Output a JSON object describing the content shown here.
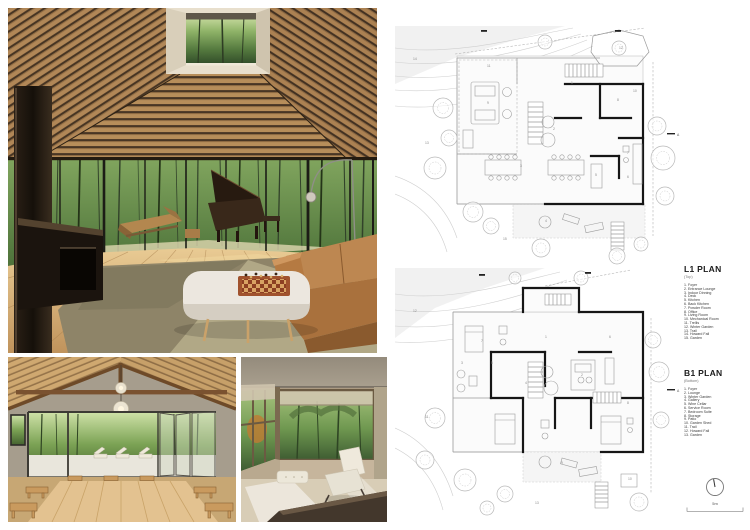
{
  "board": {
    "type": "architecture-presentation-sheet",
    "background": "#ffffff"
  },
  "palette": {
    "ceiling_wood": "#b78e5a",
    "ceiling_gap": "#483624",
    "forest_green": "#55793f",
    "floor_oak": "#d9b379",
    "sofa_leather": "#b3793f",
    "rug_olive": "#8e8468",
    "marble_table": "#ece7df",
    "fireplace_bronze": "#231a12",
    "plan_wall": "#161616",
    "plan_line": "#9a9a9a"
  },
  "renders": {
    "main": {
      "name": "living-room-render"
    },
    "pavilion": {
      "name": "dining-pavilion-render"
    },
    "nook": {
      "name": "window-nook-render"
    }
  },
  "plans": {
    "scale_label": "5m",
    "l1": {
      "title": "L1 PLAN",
      "subtitle": "(Top)",
      "section_letter": "A",
      "legend": [
        "Foyer",
        "Entrance Lounge",
        "Indoor Dinning",
        "Deck",
        "Kitchen",
        "Back Kitchen",
        "Powder Room",
        "Office",
        "Living Room",
        "Mechanical Room",
        "Trellis",
        "Winter Garden",
        "Trail",
        "Howard Fall",
        "Garden"
      ],
      "room_numbers": [
        {
          "n": "1",
          "x": 176,
          "y": 58
        },
        {
          "n": "2",
          "x": 158,
          "y": 104
        },
        {
          "n": "3",
          "x": 125,
          "y": 141
        },
        {
          "n": "4",
          "x": 150,
          "y": 196
        },
        {
          "n": "5",
          "x": 200,
          "y": 150
        },
        {
          "n": "6",
          "x": 232,
          "y": 152
        },
        {
          "n": "7",
          "x": 232,
          "y": 128
        },
        {
          "n": "8",
          "x": 222,
          "y": 75
        },
        {
          "n": "9",
          "x": 92,
          "y": 78
        },
        {
          "n": "10",
          "x": 238,
          "y": 66
        },
        {
          "n": "11",
          "x": 92,
          "y": 41
        },
        {
          "n": "12",
          "x": 224,
          "y": 23
        },
        {
          "n": "13",
          "x": 30,
          "y": 118
        },
        {
          "n": "14",
          "x": 18,
          "y": 34
        },
        {
          "n": "15",
          "x": 108,
          "y": 214
        }
      ]
    },
    "b1": {
      "title": "B1 PLAN",
      "subtitle": "(Bottom)",
      "section_letter": "A",
      "legend": [
        "Foyer",
        "Lounge",
        "Winter Garden",
        "Gallery",
        "Wine Cellar",
        "Service Room",
        "Bedroom Suite",
        "Storage",
        "Patio",
        "Garden Shed",
        "Trail",
        "Howard Fall",
        "Garden"
      ],
      "room_numbers": [
        {
          "n": "1",
          "x": 150,
          "y": 70
        },
        {
          "n": "2",
          "x": 186,
          "y": 108
        },
        {
          "n": "3",
          "x": 66,
          "y": 96
        },
        {
          "n": "4",
          "x": 130,
          "y": 116
        },
        {
          "n": "5",
          "x": 96,
          "y": 96
        },
        {
          "n": "6",
          "x": 214,
          "y": 70
        },
        {
          "n": "7",
          "x": 86,
          "y": 74
        },
        {
          "n": "8",
          "x": 232,
          "y": 136
        },
        {
          "n": "9",
          "x": 166,
          "y": 196
        },
        {
          "n": "10",
          "x": 233,
          "y": 212
        },
        {
          "n": "11",
          "x": 30,
          "y": 150
        },
        {
          "n": "12",
          "x": 18,
          "y": 44
        },
        {
          "n": "13",
          "x": 140,
          "y": 236
        }
      ]
    }
  }
}
